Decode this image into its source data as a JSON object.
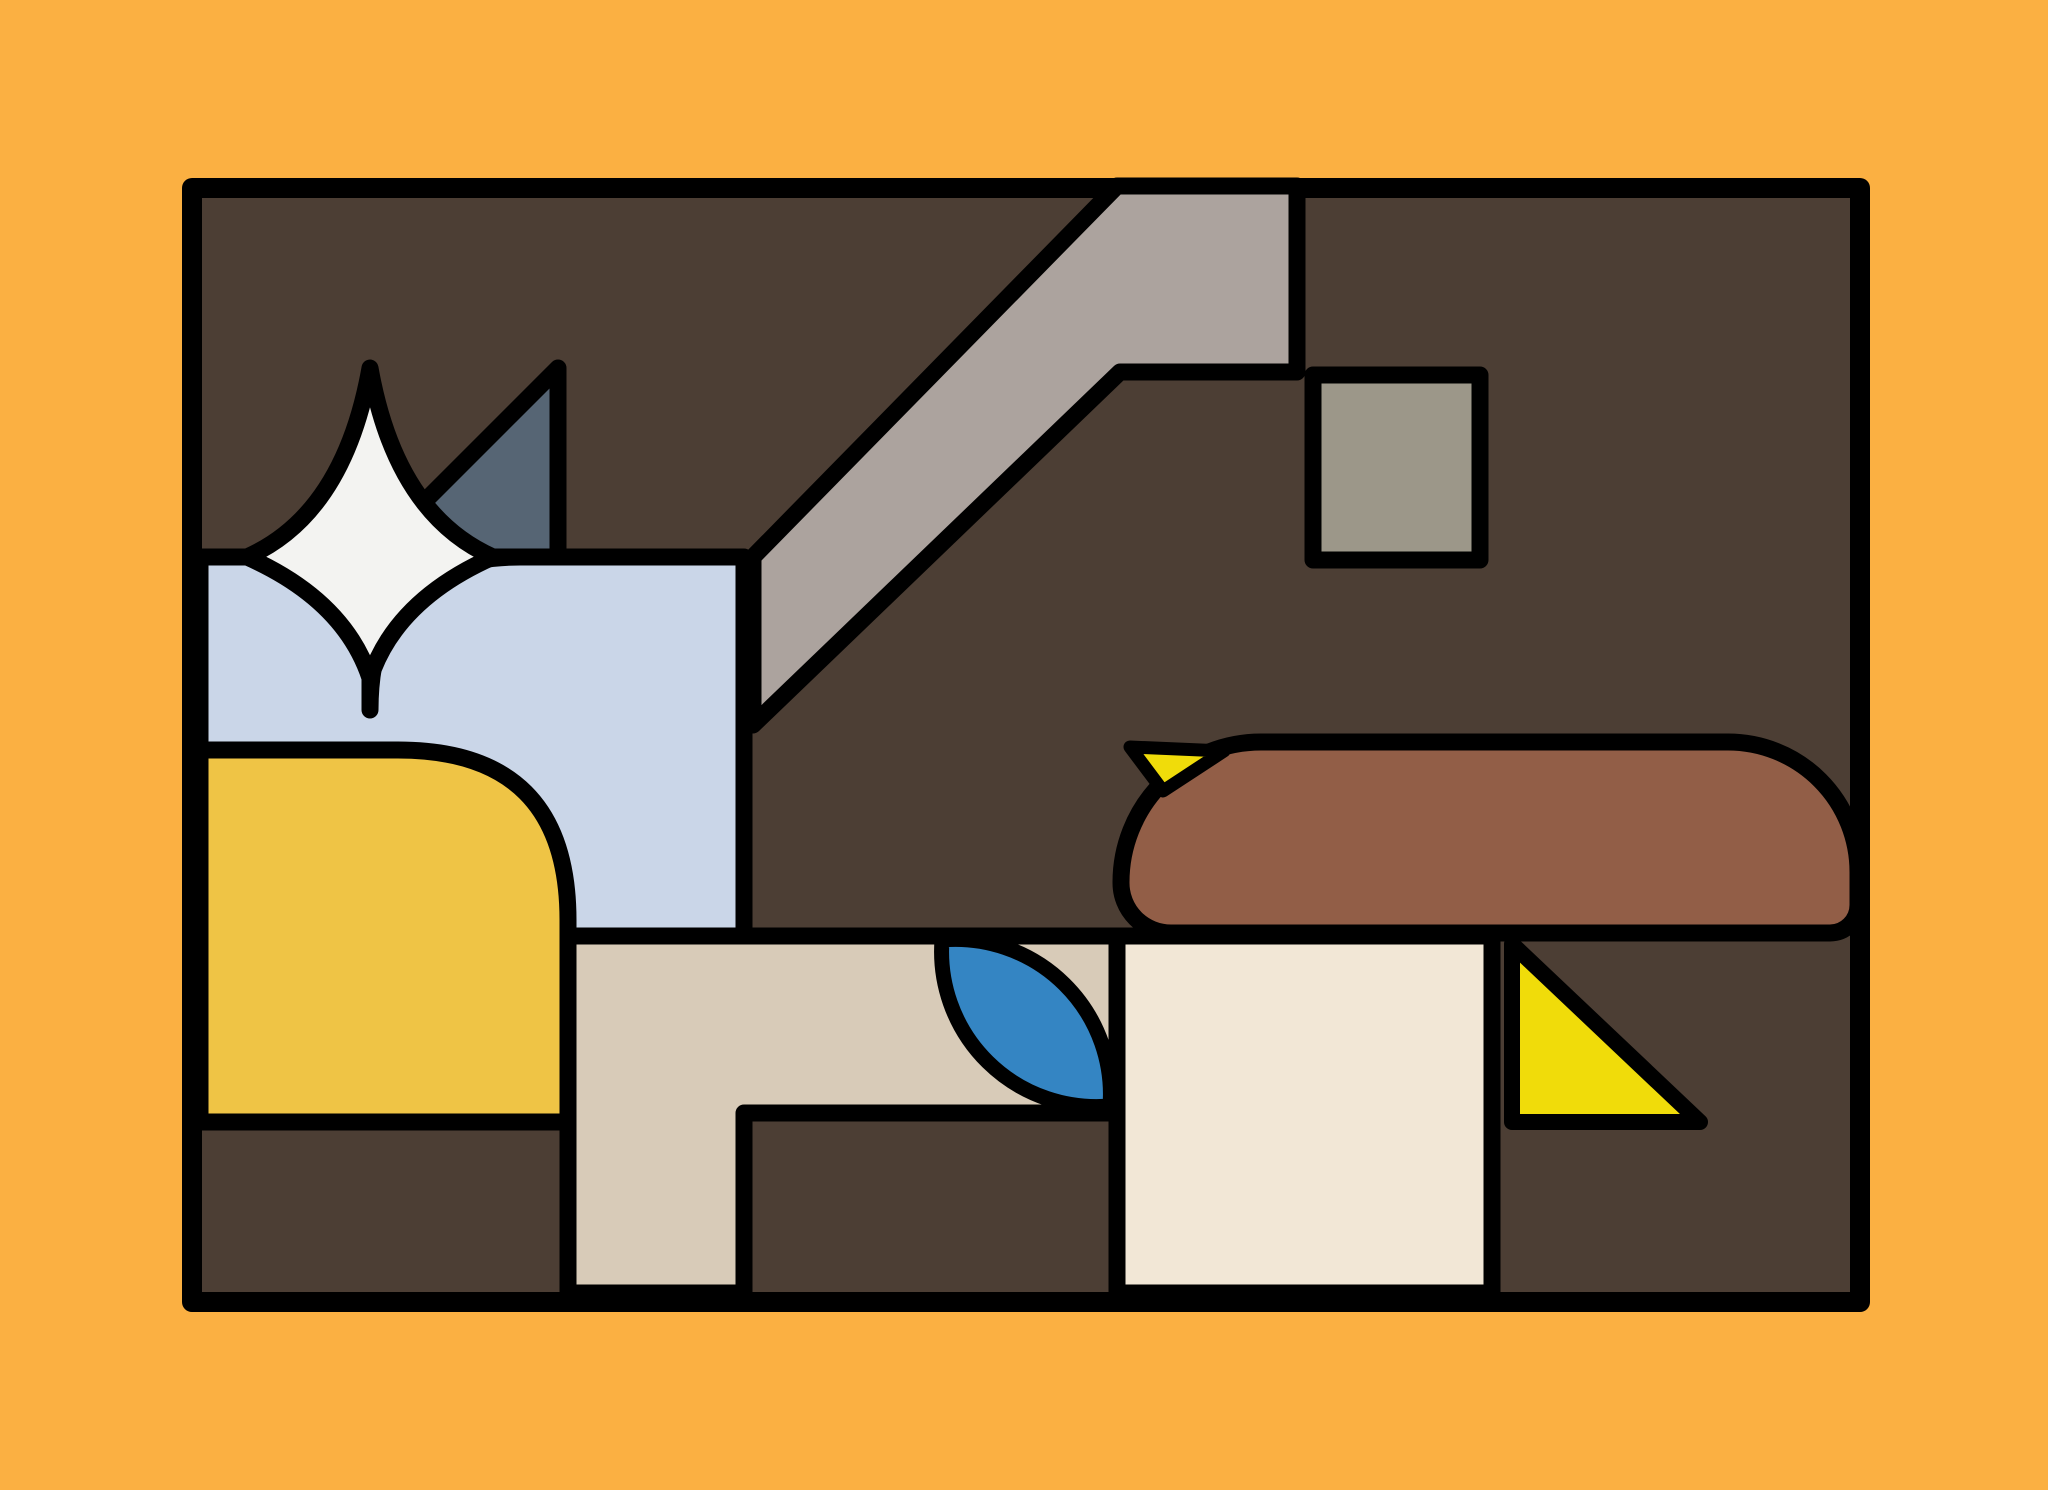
{
  "artwork": {
    "title": "abstract-stained-glass-composition",
    "canvas_width": 2048,
    "canvas_height": 1490
  },
  "palette": {
    "mat_orange": "#FBB042",
    "panel_dark_brown": "#4C3E34",
    "outline_black": "#000000",
    "band_warm_gray": "#ACA39E",
    "block_olive_gray": "#9C9789",
    "star_white": "#F3F3F1",
    "triangle_slate_blue": "#566574",
    "sky_light_blue": "#CAD6E8",
    "block_golden_yellow": "#EFC445",
    "accent_bright_yellow": "#F0DC0A",
    "loaf_warm_brown": "#925E47",
    "floor_tan": "#D8CBB8",
    "panel_cream": "#F2E7D6",
    "leaf_blue": "#3485C3"
  },
  "shapes": [
    {
      "name": "outer-mat",
      "color_key": "mat_orange"
    },
    {
      "name": "glass-frame-panel",
      "color_key": "panel_dark_brown"
    },
    {
      "name": "diagonal-band",
      "color_key": "band_warm_gray"
    },
    {
      "name": "hanging-square-block",
      "color_key": "block_olive_gray"
    },
    {
      "name": "slate-sail-triangle",
      "color_key": "triangle_slate_blue"
    },
    {
      "name": "sky-blue-panel",
      "color_key": "sky_light_blue"
    },
    {
      "name": "golden-yellow-block",
      "color_key": "block_golden_yellow"
    },
    {
      "name": "sparkle-star",
      "color_key": "star_white"
    },
    {
      "name": "tan-floor-panel",
      "color_key": "floor_tan"
    },
    {
      "name": "cream-panel",
      "color_key": "panel_cream"
    },
    {
      "name": "blue-leaf",
      "color_key": "leaf_blue"
    },
    {
      "name": "brown-loaf",
      "color_key": "loaf_warm_brown"
    },
    {
      "name": "yellow-beak-wedge",
      "color_key": "accent_bright_yellow"
    },
    {
      "name": "yellow-corner-triangle",
      "color_key": "accent_bright_yellow"
    }
  ]
}
